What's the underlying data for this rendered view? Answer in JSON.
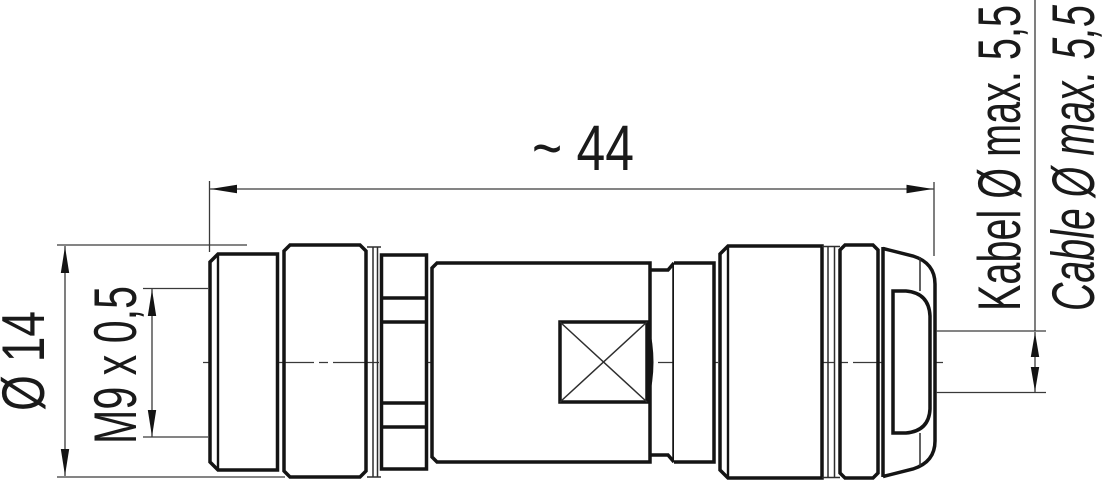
{
  "dimensions": {
    "length": "~ 44",
    "outer_diameter": "Ø 14",
    "thread": "M9 x 0,5",
    "cable_de": "Kabel Ø max. 5,5",
    "cable_en": "Cable Ø max. 5,5"
  },
  "colors": {
    "ink": "#141414",
    "thin_line": "#3a3a3a",
    "background": "#ffffff"
  }
}
